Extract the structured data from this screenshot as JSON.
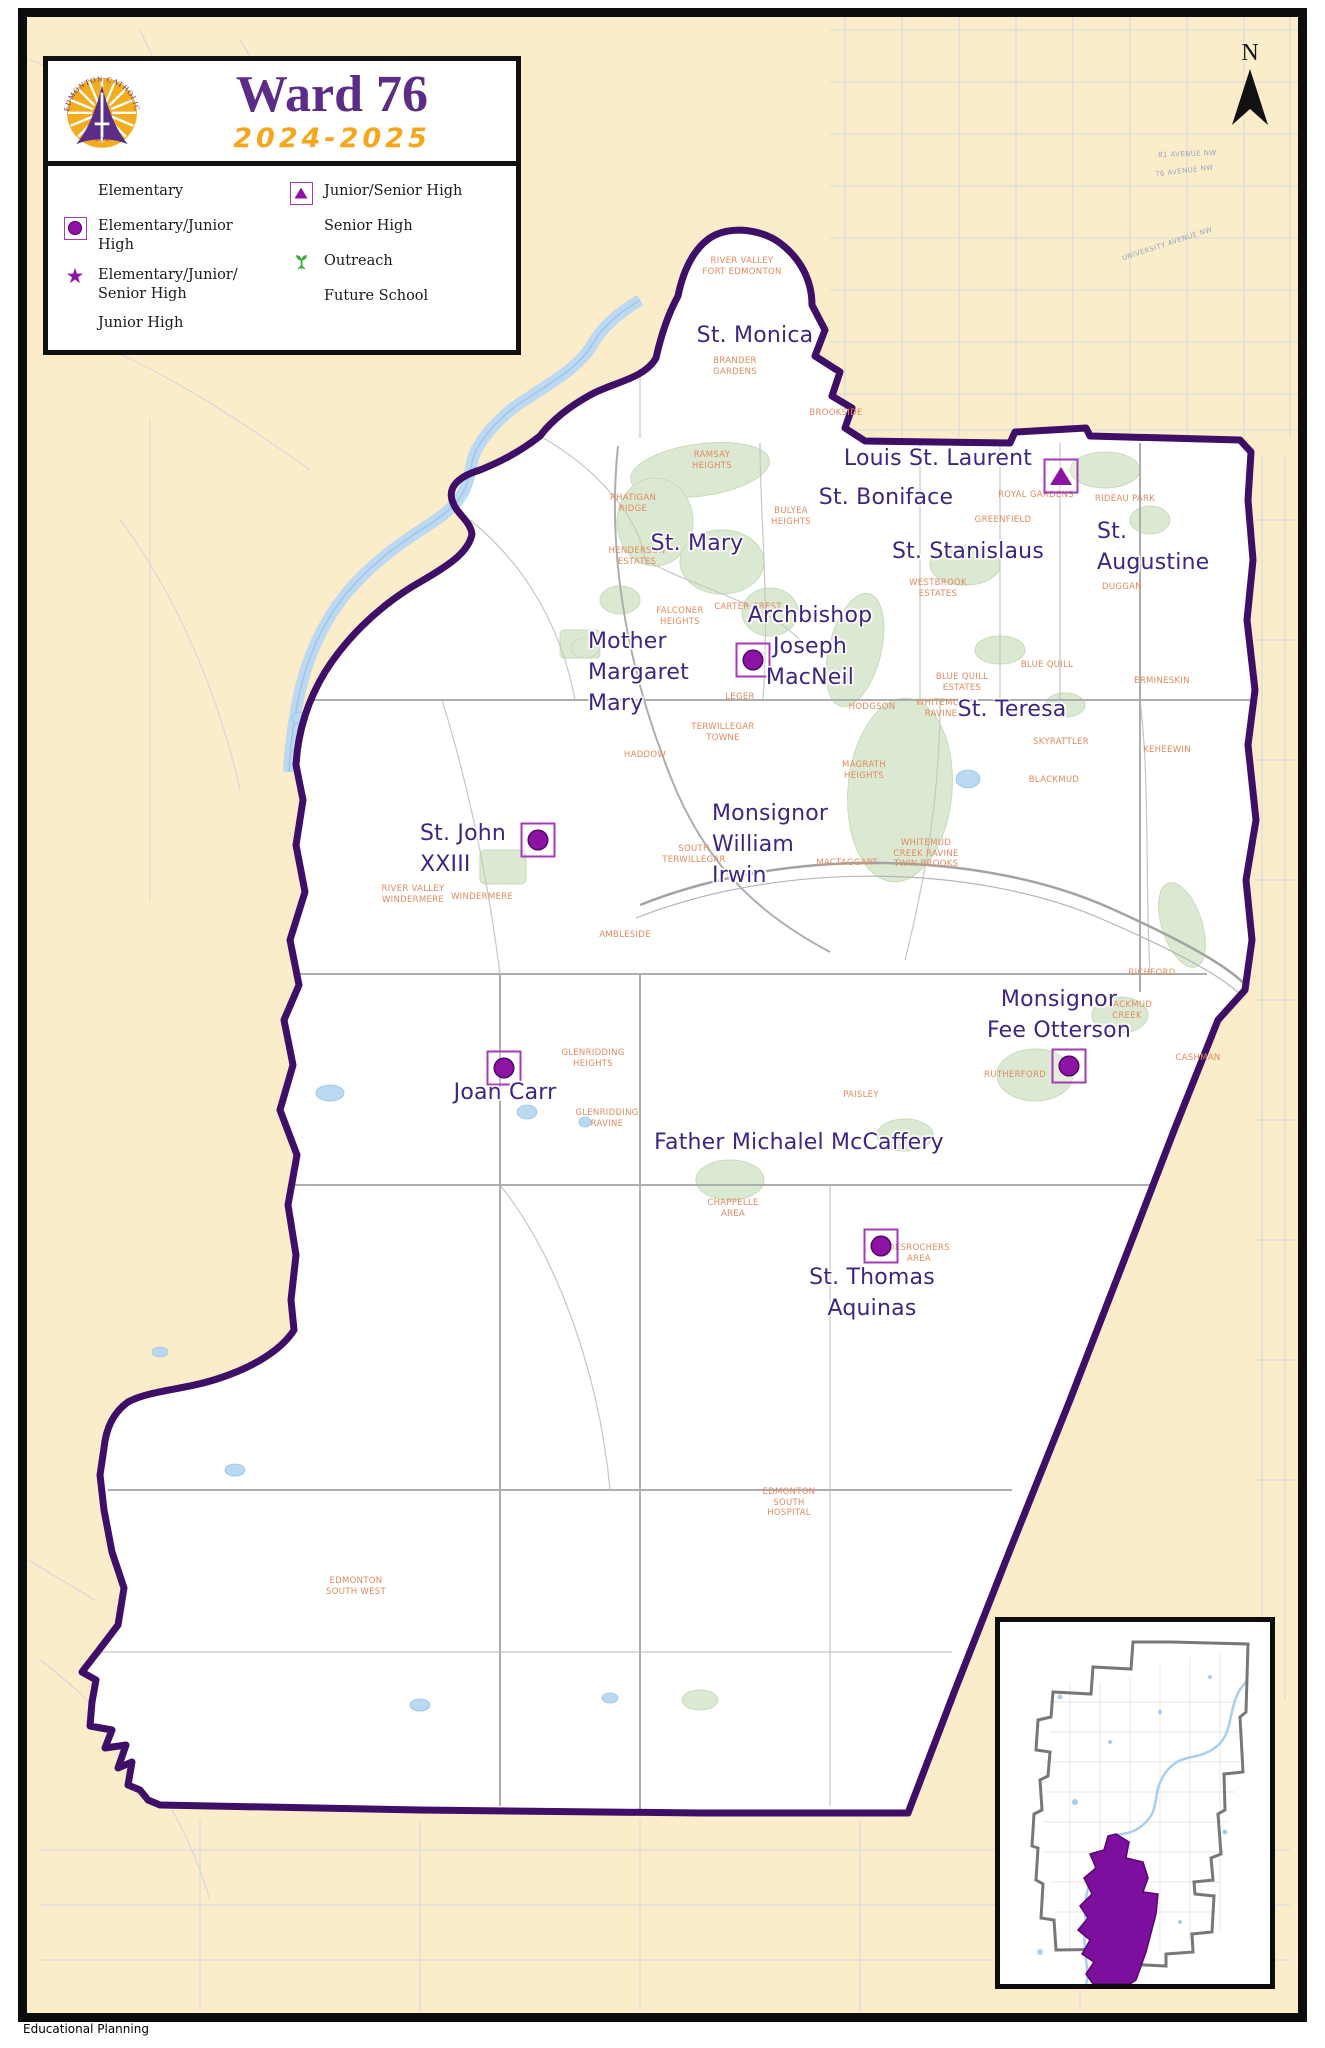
{
  "title_box": {
    "title": "Ward 76",
    "year": "2024-2025",
    "logo_arc_top": "EDMONTON CATHOLIC",
    "logo_arc_bottom": "SCHOOLS"
  },
  "north": {
    "label": "N"
  },
  "footer": {
    "text": "Educational Planning"
  },
  "colors": {
    "ward_boundary": "#3f0e66",
    "school_purple": "#8c13a4",
    "label_purple": "#3f2580",
    "neighborhood_orange": "#e08a5f",
    "outside_beige": "#fcedca",
    "water_blue": "#b9d8f2",
    "park_green": "#dce9d2",
    "title_purple": "#5b2d86",
    "year_orange": "#f5a61d",
    "future_orange": "#e8641e",
    "outreach_green": "#3aaa35"
  },
  "legend": {
    "items": [
      {
        "label": "Elementary",
        "icon": "elementary",
        "col": 1
      },
      {
        "label": "Elementary/Junior\nHigh",
        "icon": "elem-jr",
        "col": 1
      },
      {
        "label": "Elementary/Junior/\nSenior High",
        "icon": "elem-jr-sr",
        "col": 1
      },
      {
        "label": "Junior High",
        "icon": "junior",
        "col": 1
      },
      {
        "label": "Junior/Senior High",
        "icon": "jr-sr",
        "col": 2
      },
      {
        "label": "Senior High",
        "icon": "senior",
        "col": 2
      },
      {
        "label": "Outreach",
        "icon": "outreach",
        "col": 2
      },
      {
        "label": "Future School",
        "icon": "future",
        "col": 2
      }
    ]
  },
  "schools": [
    {
      "name": "St. Monica",
      "type": "elementary",
      "marker": {
        "x": 769,
        "y": 367
      },
      "label": {
        "text": "St. Monica",
        "x": 755,
        "y": 320,
        "align": "center"
      }
    },
    {
      "name": "Louis St. Laurent",
      "type": "jr-sr",
      "marker": {
        "x": 1061,
        "y": 476
      },
      "label": {
        "text": "Louis St. Laurent",
        "x": 938,
        "y": 443,
        "align": "center"
      }
    },
    {
      "name": "St. Boniface",
      "type": "elementary",
      "marker": {
        "x": 977,
        "y": 502
      },
      "label": {
        "text": "St. Boniface",
        "x": 886,
        "y": 482,
        "align": "center"
      }
    },
    {
      "name": "St. Mary",
      "type": "elementary",
      "marker": {
        "x": 707,
        "y": 511
      },
      "label": {
        "text": "St. Mary",
        "x": 697,
        "y": 528,
        "align": "center"
      }
    },
    {
      "name": "St. Stanislaus",
      "type": "elementary",
      "marker": {
        "x": 1043,
        "y": 521
      },
      "label": {
        "text": "St. Stanislaus",
        "x": 968,
        "y": 536,
        "align": "center"
      }
    },
    {
      "name": "St. Augustine",
      "type": "elementary",
      "marker": {
        "x": 1160,
        "y": 528
      },
      "label": {
        "text": "St.\nAugustine",
        "x": 1097,
        "y": 516,
        "align": "left"
      }
    },
    {
      "name": "Archbishop Joseph MacNeil",
      "type": "elem-jr",
      "marker": {
        "x": 753,
        "y": 660
      },
      "label": {
        "text": "Archbishop\nJoseph\nMacNeil",
        "x": 810,
        "y": 600,
        "align": "center"
      }
    },
    {
      "name": "Mother Margaret Mary",
      "type": "senior",
      "marker": {
        "x": 726,
        "y": 664
      },
      "label": {
        "text": "Mother\nMargaret\nMary",
        "x": 588,
        "y": 626,
        "align": "left"
      }
    },
    {
      "name": "St. Teresa",
      "type": "elementary",
      "marker": {
        "x": 1035,
        "y": 685
      },
      "label": {
        "text": "St. Teresa",
        "x": 1012,
        "y": 694,
        "align": "center"
      }
    },
    {
      "name": "Monsignor William Irwin",
      "type": "elementary",
      "marker": {
        "x": 763,
        "y": 775
      },
      "label": {
        "text": "Monsignor\nWilliam\nIrwin",
        "x": 712,
        "y": 798,
        "align": "left"
      }
    },
    {
      "name": "St. John XXIII",
      "type": "elem-jr",
      "marker": {
        "x": 538,
        "y": 840
      },
      "label": {
        "text": "St. John\nXXIII",
        "x": 420,
        "y": 818,
        "align": "left"
      }
    },
    {
      "name": "Joan Carr",
      "type": "elem-jr",
      "marker": {
        "x": 504,
        "y": 1068
      },
      "label": {
        "text": "Joan Carr",
        "x": 505,
        "y": 1077,
        "align": "center"
      }
    },
    {
      "name": "Monsignor Fee Otterson",
      "type": "elem-jr",
      "marker": {
        "x": 1069,
        "y": 1066
      },
      "label": {
        "text": "Monsignor\nFee Otterson",
        "x": 1059,
        "y": 984,
        "align": "center"
      }
    },
    {
      "name": "Father Michalel McCaffery",
      "type": "senior",
      "marker": {
        "x": 917,
        "y": 1177
      },
      "label": {
        "text": "Father Michalel McCaffery",
        "x": 799,
        "y": 1127,
        "align": "center"
      }
    },
    {
      "name": "St. Thomas Aquinas",
      "type": "elem-jr",
      "marker": {
        "x": 881,
        "y": 1246
      },
      "label": {
        "text": "St. Thomas\nAquinas",
        "x": 872,
        "y": 1262,
        "align": "center"
      }
    }
  ],
  "neighborhoods": [
    {
      "name": "RIVER VALLEY\nFORT EDMONTON",
      "x": 742,
      "y": 256
    },
    {
      "name": "BRANDER\nGARDENS",
      "x": 735,
      "y": 356
    },
    {
      "name": "BROOKSIDE",
      "x": 836,
      "y": 408
    },
    {
      "name": "RAMSAY\nHEIGHTS",
      "x": 712,
      "y": 450
    },
    {
      "name": "RHATIGAN\nRIDGE",
      "x": 633,
      "y": 493
    },
    {
      "name": "BULYEA\nHEIGHTS",
      "x": 791,
      "y": 506
    },
    {
      "name": "HENDERSON\nESTATES",
      "x": 637,
      "y": 546
    },
    {
      "name": "ROYAL GARDENS",
      "x": 1036,
      "y": 490
    },
    {
      "name": "RIDEAU PARK",
      "x": 1125,
      "y": 494
    },
    {
      "name": "GREENFIELD",
      "x": 1003,
      "y": 515
    },
    {
      "name": "WESTBROOK\nESTATES",
      "x": 938,
      "y": 578
    },
    {
      "name": "DUGGAN",
      "x": 1122,
      "y": 582
    },
    {
      "name": "FALCONER\nHEIGHTS",
      "x": 680,
      "y": 606
    },
    {
      "name": "CARTER CREST",
      "x": 748,
      "y": 602
    },
    {
      "name": "LEGER",
      "x": 740,
      "y": 692
    },
    {
      "name": "HODGSON",
      "x": 872,
      "y": 702
    },
    {
      "name": "WHITEMUD\nRAVINE",
      "x": 941,
      "y": 698
    },
    {
      "name": "TERWILLEGAR\nTOWNE",
      "x": 723,
      "y": 722
    },
    {
      "name": "HADDOW",
      "x": 645,
      "y": 750
    },
    {
      "name": "MAGRATH\nHEIGHTS",
      "x": 864,
      "y": 760
    },
    {
      "name": "BLUE QUILL\nESTATES",
      "x": 962,
      "y": 672
    },
    {
      "name": "BLUE QUILL",
      "x": 1047,
      "y": 660
    },
    {
      "name": "ERMINESKIN",
      "x": 1162,
      "y": 676
    },
    {
      "name": "SKYRATTLER",
      "x": 1061,
      "y": 737
    },
    {
      "name": "KEHEEWIN",
      "x": 1167,
      "y": 745
    },
    {
      "name": "BLACKMUD",
      "x": 1054,
      "y": 775
    },
    {
      "name": "SOUTH\nTERWILLEGAR",
      "x": 694,
      "y": 844
    },
    {
      "name": "MACTAGGART",
      "x": 847,
      "y": 858
    },
    {
      "name": "WHITEMUD\nCREEK RAVINE\nTWIN BROOKS",
      "x": 926,
      "y": 838
    },
    {
      "name": "RIVER VALLEY\nWINDERMERE",
      "x": 413,
      "y": 884
    },
    {
      "name": "WINDERMERE",
      "x": 482,
      "y": 892
    },
    {
      "name": "AMBLESIDE",
      "x": 625,
      "y": 930
    },
    {
      "name": "GLENRIDDING\nHEIGHTS",
      "x": 593,
      "y": 1048
    },
    {
      "name": "GLENRIDDING\nRAVINE",
      "x": 607,
      "y": 1108
    },
    {
      "name": "RICHFORD",
      "x": 1152,
      "y": 968
    },
    {
      "name": "BLACKMUD\nCREEK",
      "x": 1127,
      "y": 1000
    },
    {
      "name": "RUTHERFORD",
      "x": 1015,
      "y": 1070
    },
    {
      "name": "CASHMAN",
      "x": 1198,
      "y": 1053
    },
    {
      "name": "PAISLEY",
      "x": 861,
      "y": 1090
    },
    {
      "name": "CHAPPELLE\nAREA",
      "x": 733,
      "y": 1198
    },
    {
      "name": "DESROCHERS\nAREA",
      "x": 919,
      "y": 1243
    },
    {
      "name": "EDMONTON\nSOUTH\nHOSPITAL",
      "x": 789,
      "y": 1487
    },
    {
      "name": "EDMONTON\nSOUTH WEST",
      "x": 356,
      "y": 1576
    }
  ],
  "road_labels": [
    {
      "text": "81 AVENUE NW",
      "x": 1158,
      "y": 150,
      "rot": -2
    },
    {
      "text": "76 AVENUE NW",
      "x": 1155,
      "y": 167,
      "rot": -7
    },
    {
      "text": "UNIVERSITY AVENUE NW",
      "x": 1120,
      "y": 240,
      "rot": -18
    }
  ]
}
